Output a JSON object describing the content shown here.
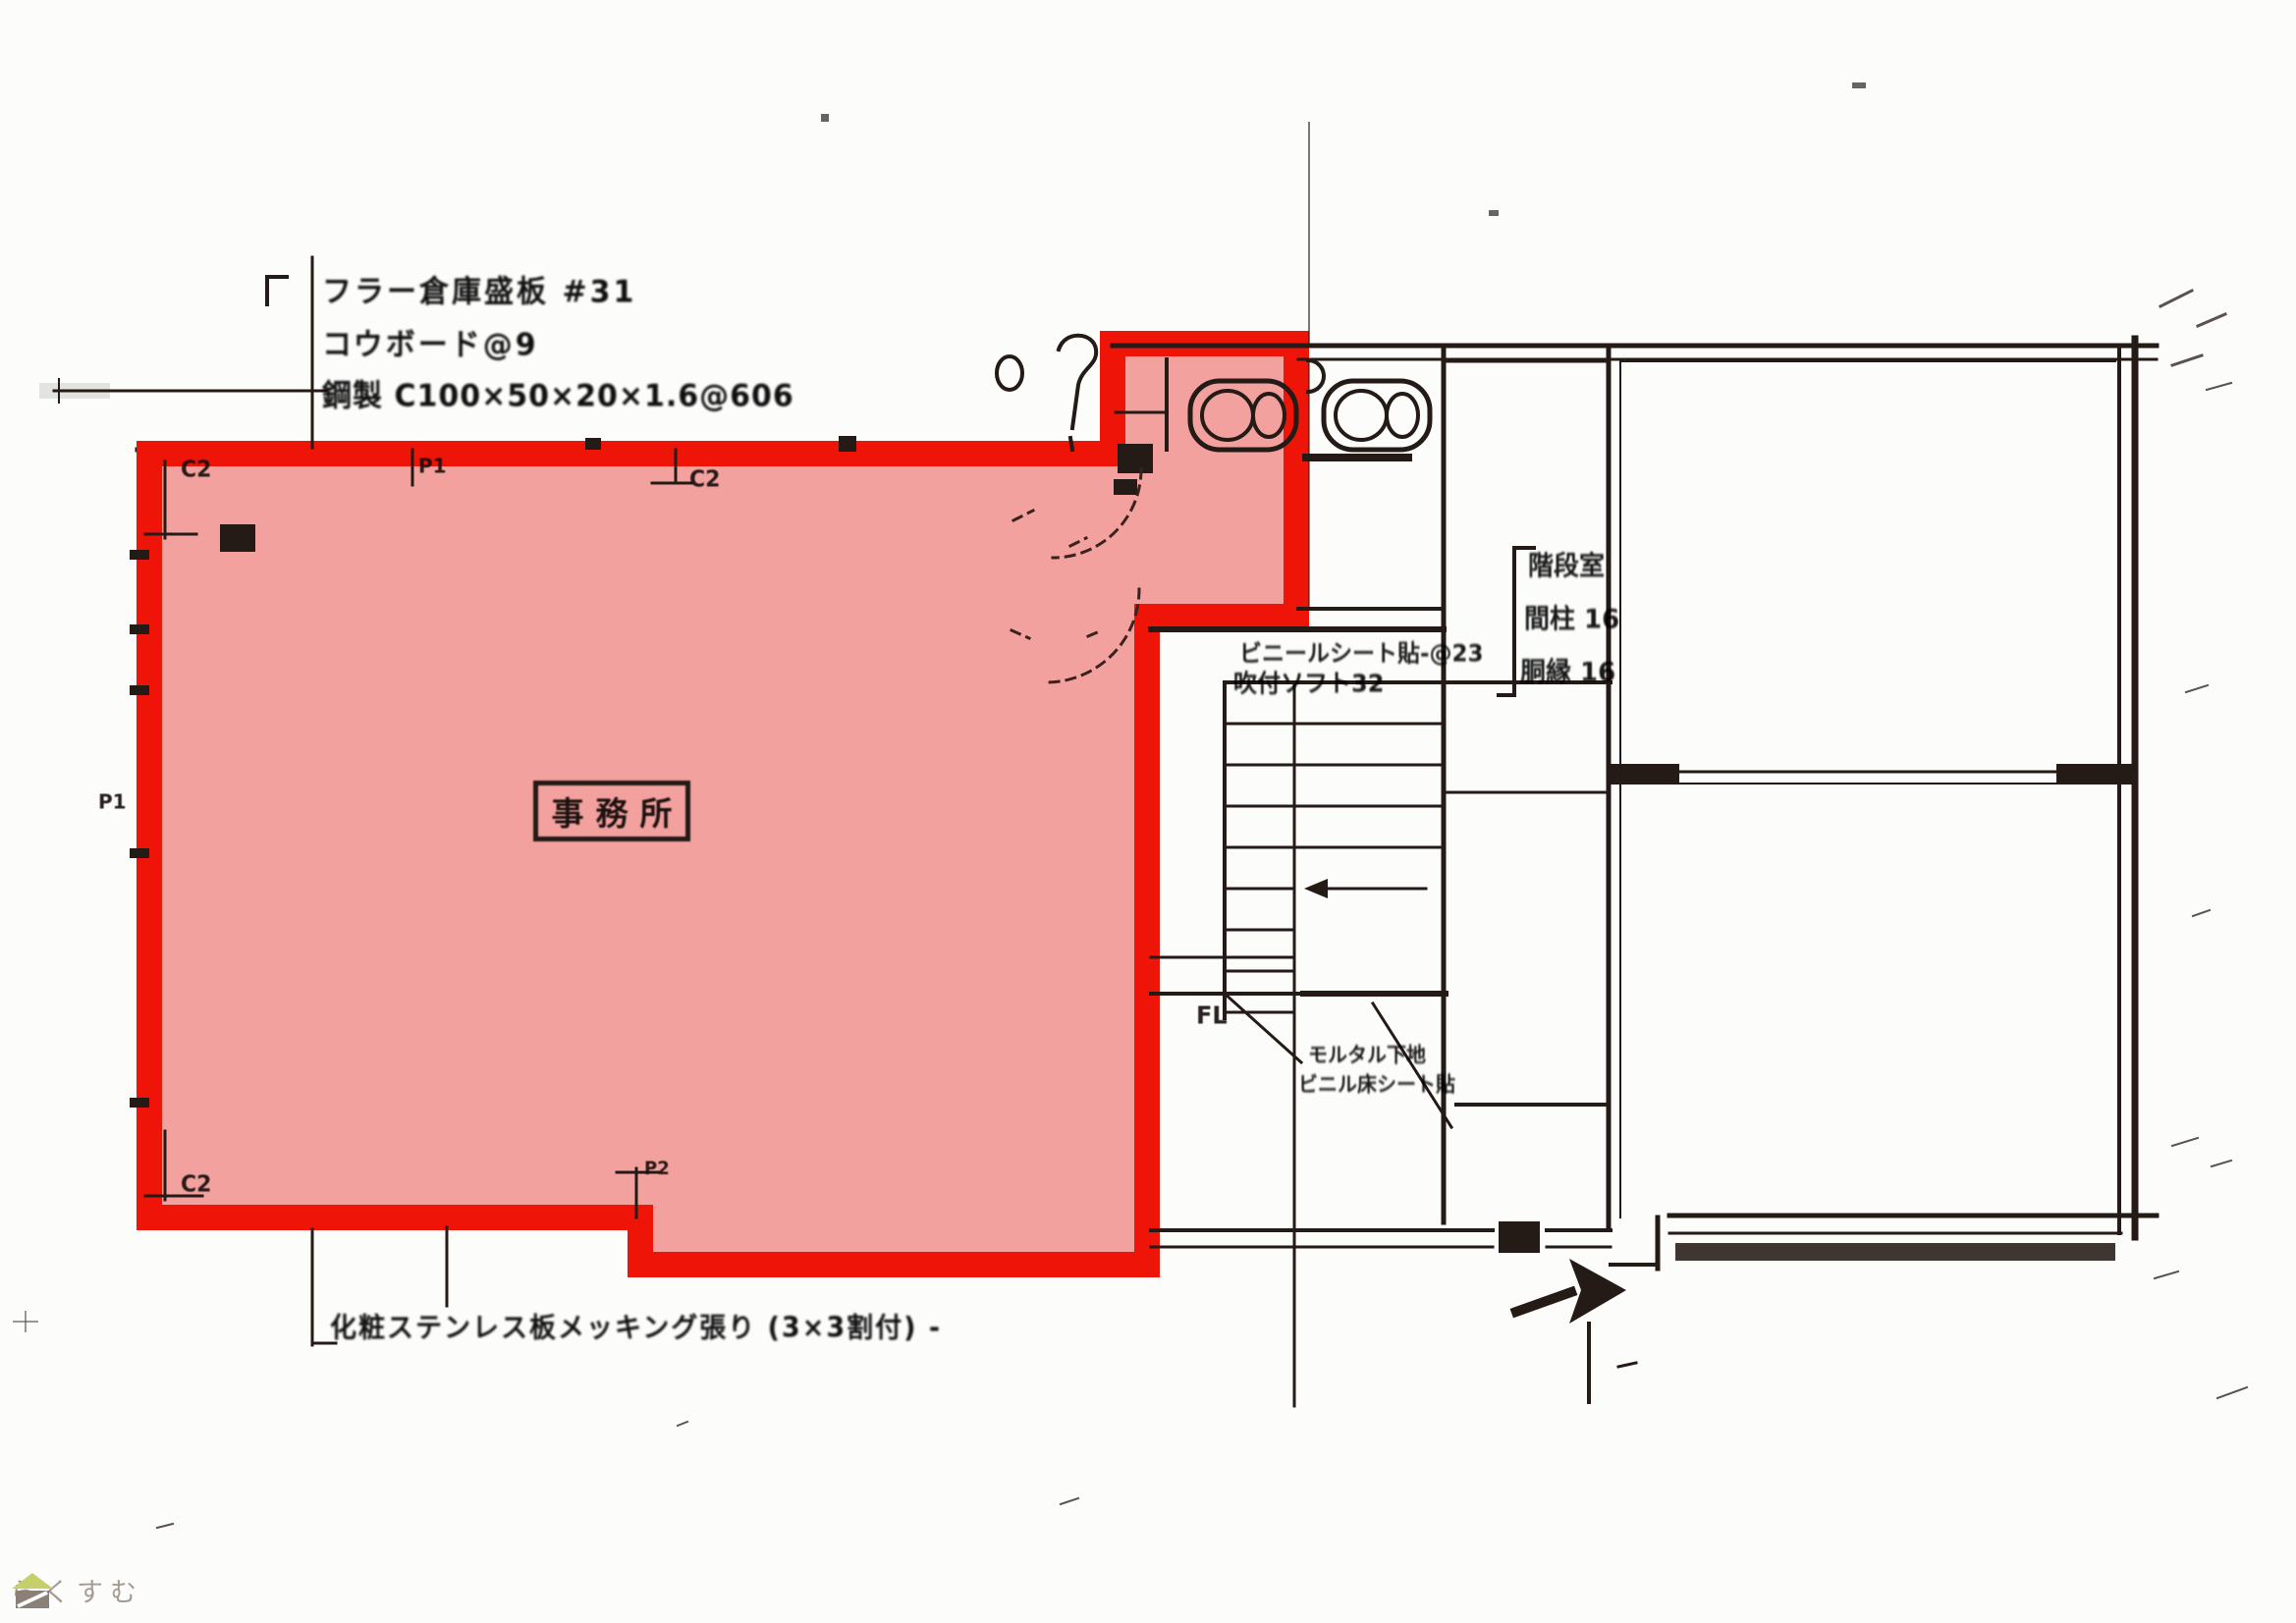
{
  "document": {
    "kind": "scanned floor plan",
    "highlight_colors": {
      "stroke": "#ee1408",
      "fill_tint": "#e8241c"
    },
    "line_color": "#1c1c1c"
  },
  "annotations": {
    "top_left": {
      "line1": "フラー倉庫盛板 #31",
      "line2": "コウボード@9",
      "line3": "鋼製 C100×50×20×1.6@606"
    },
    "room_label": "事務所",
    "stair_top": {
      "line1": "ビニールシート貼-@23",
      "line2": "吹付ソフト32"
    },
    "right_spec": {
      "line1": "階段室",
      "line2": "間柱 16",
      "line3": "胴縁 16"
    },
    "stair_mid": {
      "line1": "モルタル下地",
      "line2": "ビニル床シート貼"
    },
    "floor_level": "FL",
    "bottom_note": "化粧ステンレス板メッキング張り (3×3割付) -",
    "column_marks": {
      "c2_top_left": "C2",
      "p1_top": "P1",
      "c2_top_mid": "C2",
      "p1_left": "P1",
      "c2_bottom_left": "C2",
      "p2_bottom": "P2"
    }
  },
  "watermark": {
    "brand": "らくすむ",
    "roof_color": "#c5d06b",
    "body_color": "#8a8078",
    "text_color": "#a59c94"
  }
}
